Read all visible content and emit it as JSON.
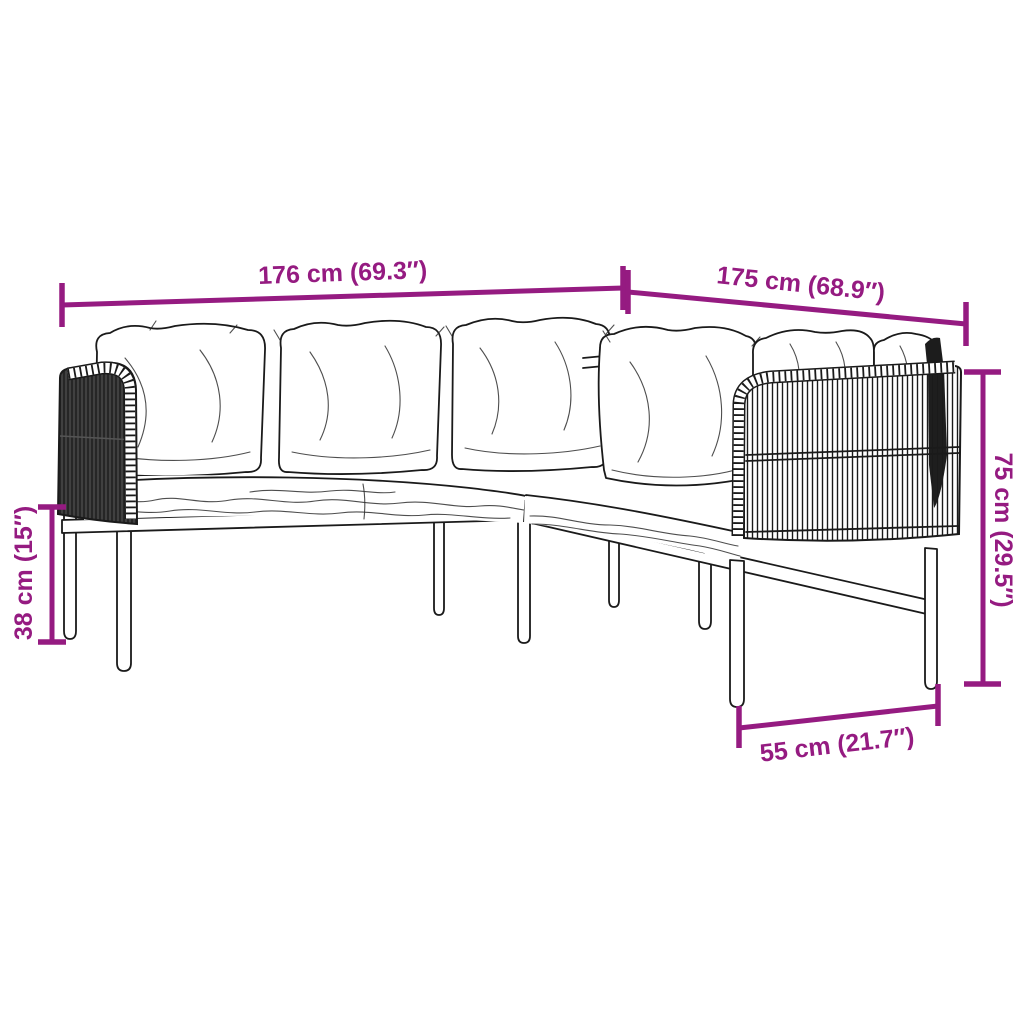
{
  "colors": {
    "accent": "#951b81",
    "line": "#1a1a1a",
    "background": "#ffffff"
  },
  "diagram": {
    "dimensions": {
      "width_left_label": "176 cm (69.3″)",
      "width_right_label": "175 cm (68.9″)",
      "backrest_height_label": "75 cm (29.5″)",
      "seat_height_label": "38 cm (15″)",
      "seat_depth_label": "55 cm (21.7″)"
    }
  }
}
